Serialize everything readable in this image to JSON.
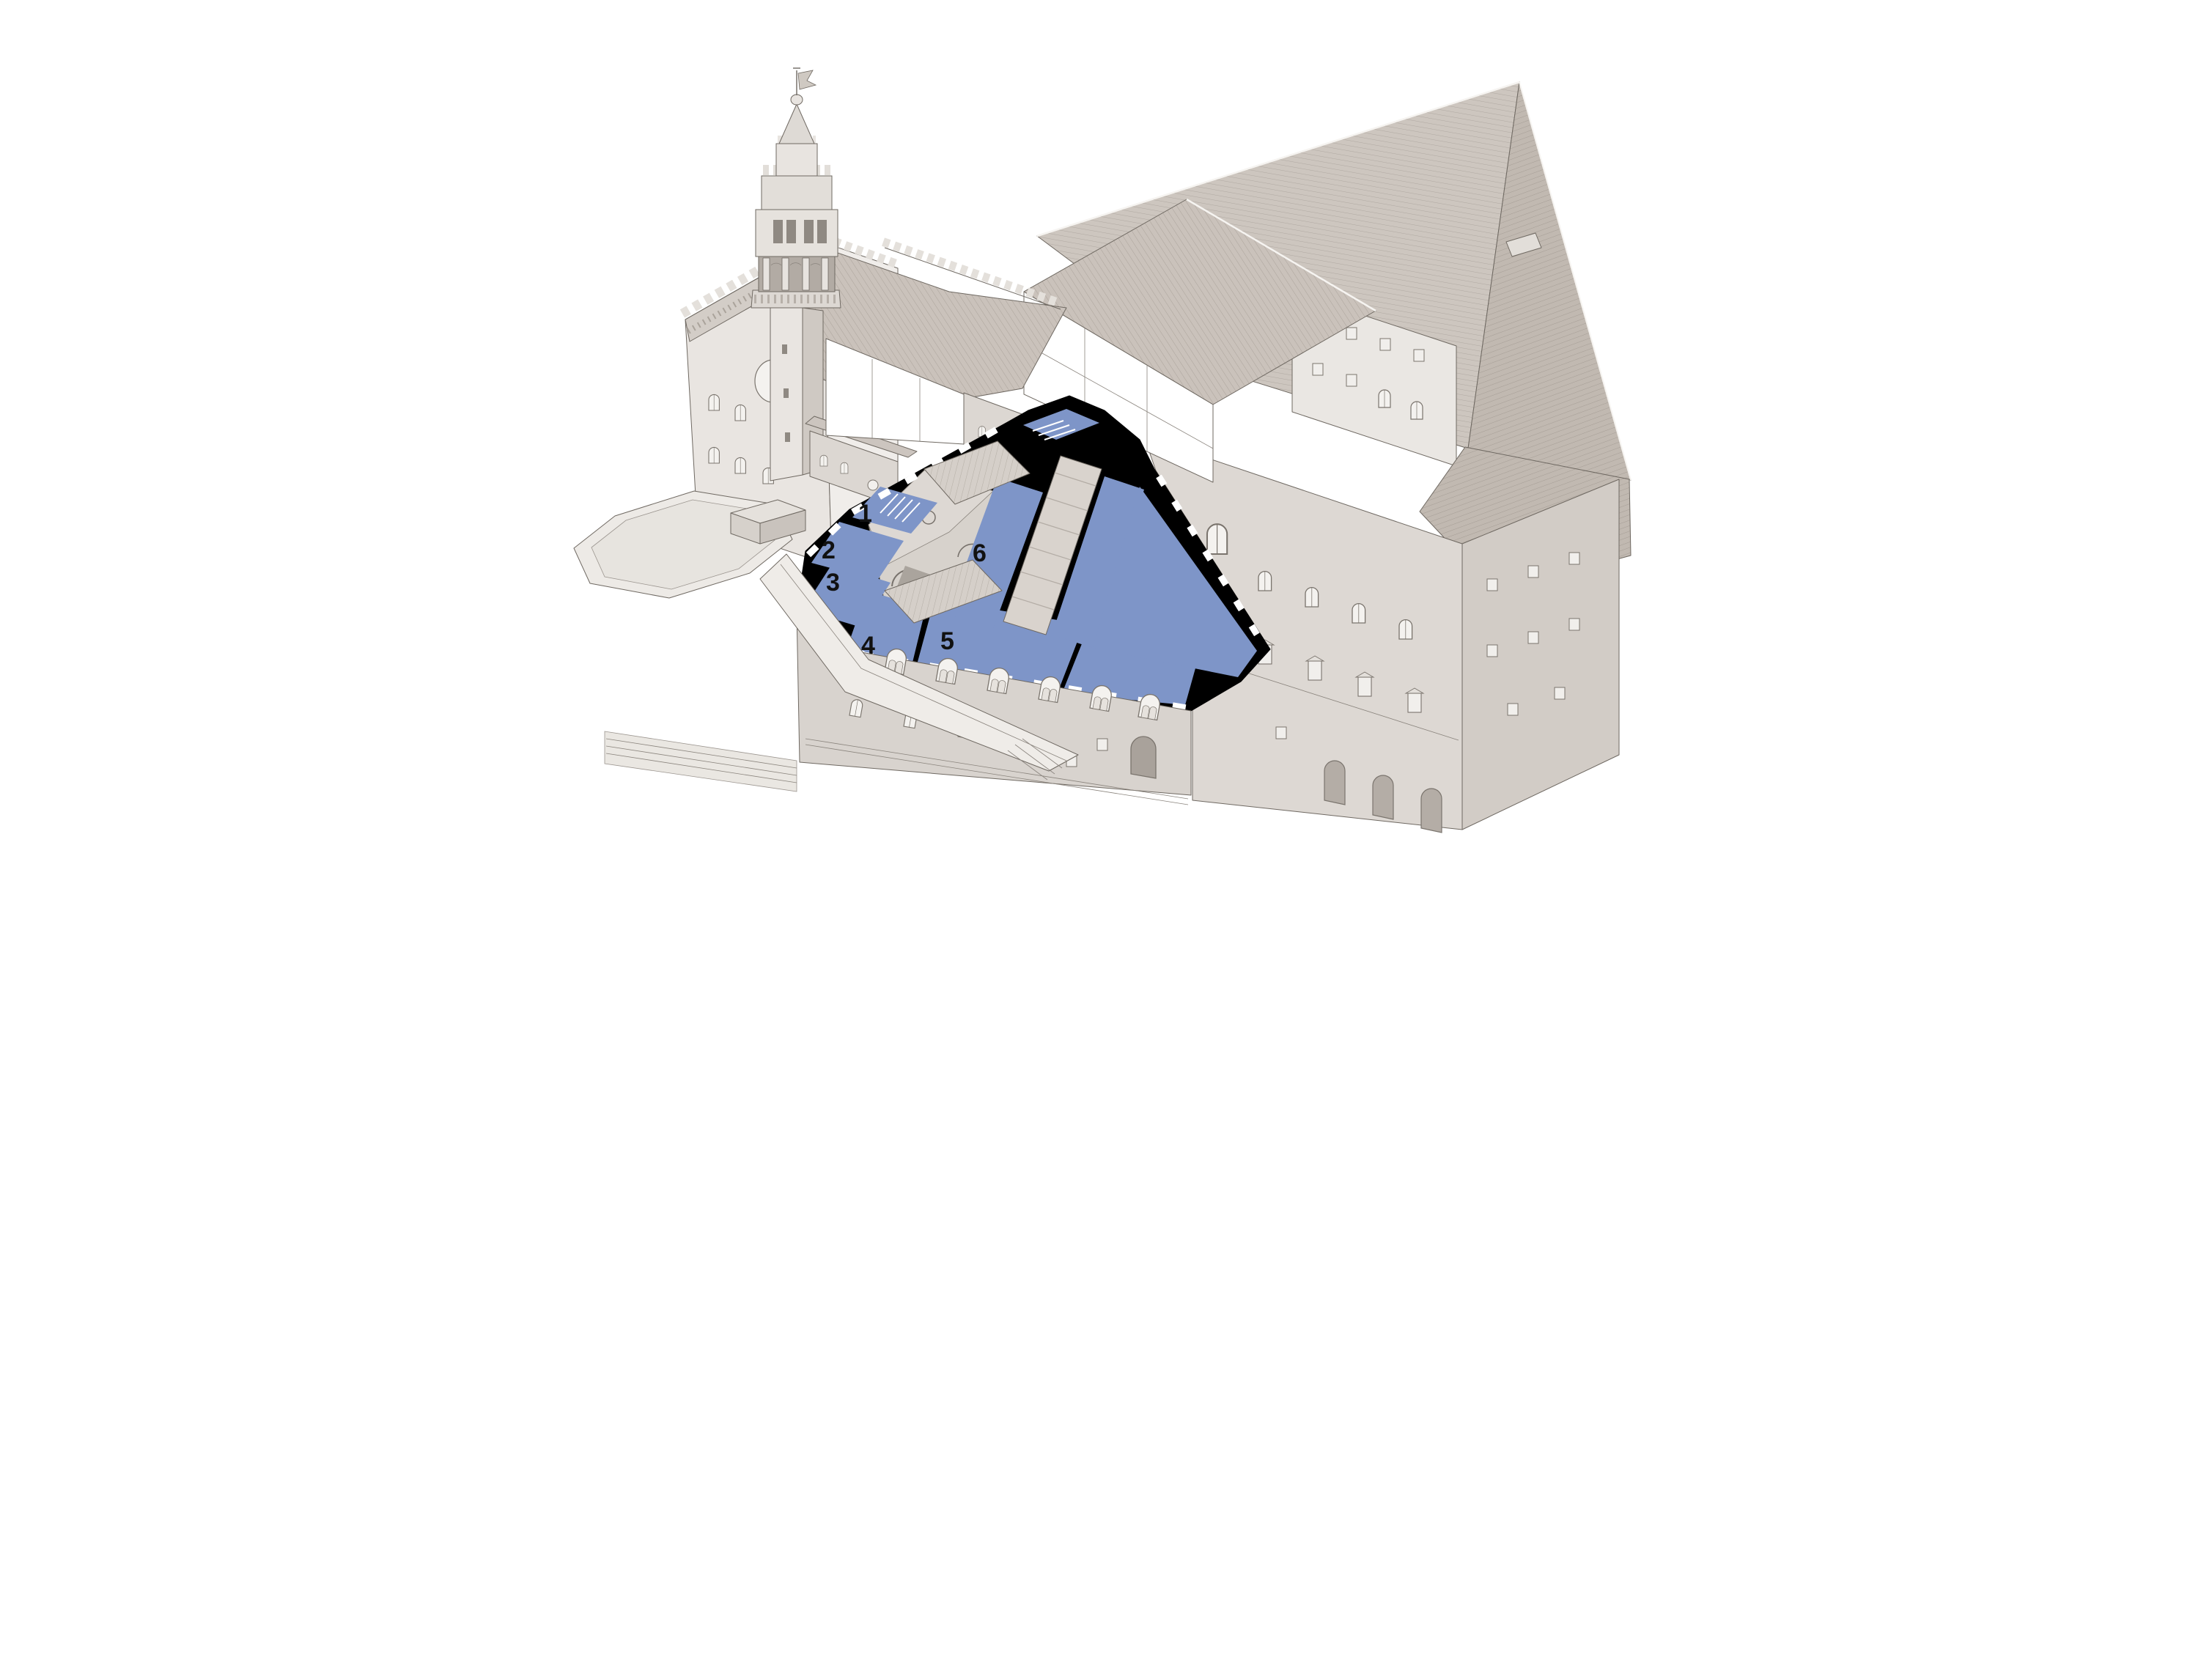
{
  "figure": {
    "type": "architectural-axonometric-cutaway",
    "subject": "Palazzo Vecchio and adjoining complex, Florence",
    "description": "Axonometric cutaway drawing: the buildings are sliced horizontally and the mezzanine floor plan is highlighted in blue, with rooms numbered 1 to 6 around the central courtyard",
    "background_color": "#ffffff"
  },
  "colors": {
    "plan_highlight": "#7E95C8",
    "cut_wall": "#000000",
    "section_plane": "#ffffff",
    "roof_a": "#CDC6BF",
    "roof_b": "#C1B9B1",
    "roof_c": "#CAC2BB",
    "roof_small": "#D5CFC9",
    "facade_light": "#E9E5E1",
    "facade_mid": "#D8D3CE",
    "facade_dark": "#CFC9C3",
    "line": "#6F6962",
    "label": "#111111"
  },
  "plan": {
    "rooms": [
      {
        "number": "1"
      },
      {
        "number": "2"
      },
      {
        "number": "3"
      },
      {
        "number": "4"
      },
      {
        "number": "5"
      },
      {
        "number": "6"
      }
    ]
  }
}
